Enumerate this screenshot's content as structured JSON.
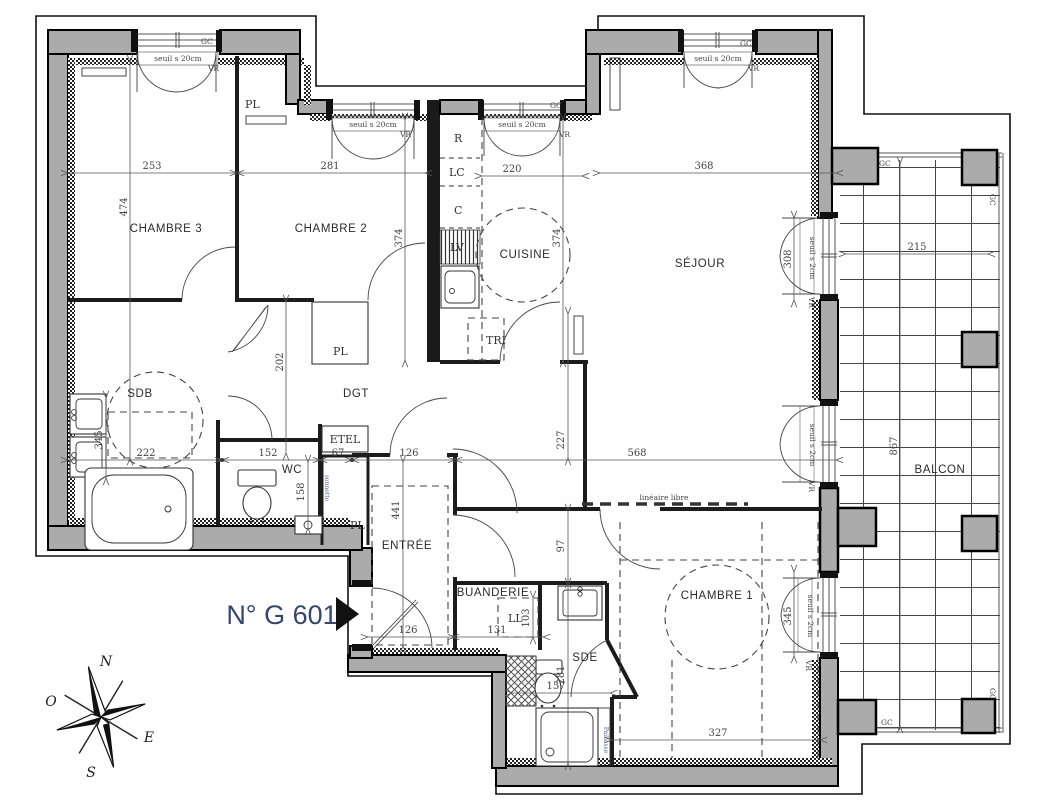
{
  "title": {
    "unit": "N° G 601"
  },
  "rooms": {
    "chambre3": "CHAMBRE 3",
    "chambre2": "CHAMBRE 2",
    "cuisine": "CUISINE",
    "sejour": "SÉJOUR",
    "sdb": "SDB",
    "dgt": "DGT",
    "wc": "WC",
    "entree": "ENTRÉE",
    "buanderie": "BUANDERIE",
    "sde": "SDE",
    "chambre1": "CHAMBRE 1",
    "balcon": "BALCON"
  },
  "closets": {
    "pl": "PL",
    "etel": "ETEL",
    "tri": "TRI"
  },
  "appliances": {
    "r": "R",
    "lc": "LC",
    "c": "C",
    "lv": "LV",
    "ll": "LL"
  },
  "annotations": {
    "lineaire_libre": "linéaire libre",
    "paillasse": "Paillasse",
    "sonnette": "sonnette",
    "seuil_20": "seuil s 20cm",
    "seuil_2": "seuil s 2cm",
    "vr": "VR",
    "gc": "GC"
  },
  "dimensions": {
    "d253": "253",
    "d281_ch2": "281",
    "d220": "220",
    "d368": "368",
    "d474": "474",
    "d374_ch2": "374",
    "d374_cui": "374",
    "d308": "308",
    "d215": "215",
    "d867": "867",
    "d222": "222",
    "d152": "152",
    "d67": "67",
    "d126_top": "126",
    "d568": "568",
    "d202": "202",
    "d227": "227",
    "d97": "97",
    "d441": "441",
    "d158": "158",
    "d345_sdb": "345",
    "d126_bot": "126",
    "d131": "131",
    "d103": "103",
    "d157": "157",
    "d281_sde": "281",
    "d327": "327",
    "d345_ch1": "345"
  },
  "compass": {
    "n": "N",
    "s": "S",
    "e": "E",
    "o": "O"
  }
}
